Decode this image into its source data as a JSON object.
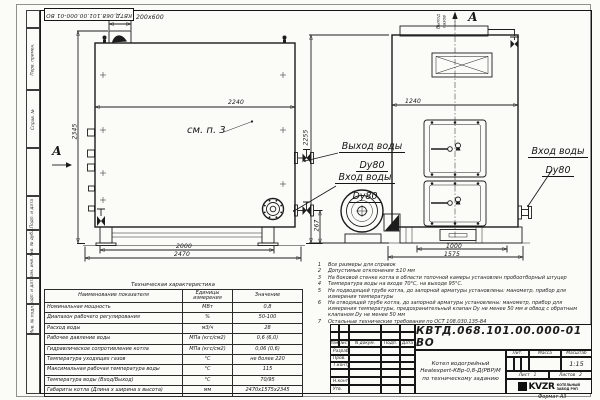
{
  "drawing": {
    "doc_number": "КВТД.068.101.00.000-01 ВО",
    "format_label": "Формат А3"
  },
  "frame": {
    "left_labels": [
      "Перв. примен.",
      "Справ. №",
      "Подп. и дата",
      "Инв. № дубл.",
      "Взам. инв. №",
      "Подп. и дата",
      "Инв. № подл."
    ]
  },
  "side_view": {
    "dim_chimney": "200х600",
    "dim_width": "2240",
    "dim_height": "2345",
    "dim_supports": "2000",
    "dim_length": "2470",
    "dim_conn_height": "267",
    "dim_front_height": "2255",
    "view_arrow_label": "А",
    "callout": "см. п. 3",
    "label_water_out": "Выход воды",
    "label_water_out_dn": "Dy80",
    "label_water_in": "Вход воды",
    "label_water_in_dn": "Dy80"
  },
  "front_view": {
    "section_label": "А",
    "gas_out_line1": "Выход",
    "gas_out_line2": "газов",
    "dim_width": "1240",
    "dim_base": "1000",
    "dim_base_overall": "1575",
    "label_water_in": "Вход воды",
    "label_water_in_dn": "Dy80"
  },
  "spec_table": {
    "title": "Техническая характеристика",
    "col_name": "Наименование показателя",
    "col_units": "Единицы измерения",
    "col_value": "Значение",
    "rows": [
      {
        "name": "Номинальная мощность",
        "units": "МВт",
        "value": "0,8"
      },
      {
        "name": "Диапазон рабочего регулирования",
        "units": "%",
        "value": "50-100"
      },
      {
        "name": "Расход воды",
        "units": "м3/ч",
        "value": "28"
      },
      {
        "name": "Рабочее давление воды",
        "units": "МПа (кгс/см2)",
        "value": "0,6 (6,0)"
      },
      {
        "name": "Гидравлическое сопротивление котла",
        "units": "МПа (кгс/см2)",
        "value": "0,06 (0,6)"
      },
      {
        "name": "Температура уходящих газов",
        "units": "°С",
        "value": "не более 220"
      },
      {
        "name": "Максимальная рабочая температура воды",
        "units": "°С",
        "value": "115"
      },
      {
        "name": "Температура воды (Вход/Выход)",
        "units": "°С",
        "value": "70/95"
      },
      {
        "name": "Габариты котла (Длина х ширина х высота)",
        "units": "мм",
        "value": "2470х1575х2345"
      }
    ]
  },
  "notes": {
    "items": [
      {
        "n": "1",
        "t": "Все размеры для справок"
      },
      {
        "n": "2",
        "t": "Допустимые отклонения ±10 мм"
      },
      {
        "n": "3",
        "t": "На боковой стенке котла в области топочной камеры установлен пробоотборный штуцер"
      },
      {
        "n": "4",
        "t": "Температура воды на входе 70°С, на выходе 95°С."
      },
      {
        "n": "5",
        "t": "На подводящей трубе котла, до запорной арматуры установлены: манометр, прибор для измерения температуры"
      },
      {
        "n": "6",
        "t": "На отводящей трубе котла, до запорной арматуры установлены: манометр, прибор для измерения температуры, предохранительный клапан Dy не менее 50 мм и обвод с обратным клапаном Dy не менее 50 мм"
      },
      {
        "n": "7",
        "t": "Остальные технические требования по ОСТ 108.030.135-84"
      }
    ]
  },
  "title_block": {
    "doc_number": "КВТД.068.101.00.000-01 ВО",
    "name_line1": "Котел водогрейный",
    "name_line2": "Heatexpert-КВр-0,8-Д(РВР)М",
    "name_line3": "по техническому заданию",
    "col_izm": "Изм.",
    "col_list": "Лист",
    "col_doc": "N докум.",
    "col_podp": "Подп.",
    "col_data": "Дата",
    "row_razrab": "Разраб.",
    "row_prov": "Пров.",
    "row_tkontr": "Т.контр.",
    "row_nkontr": "Н.контр.",
    "row_utv": "Утв.",
    "lit_label": "Лит.",
    "mass_label": "Масса",
    "scale_label": "Масштаб",
    "scale_value": "1:15",
    "sheet_label": "Лист",
    "sheet_value": "1",
    "sheets_label": "Листов",
    "sheets_value": "2",
    "logo_text": "KVZR",
    "company_line1": "КОТЕЛЬНЫЙ",
    "company_line2": "ЗАВОД РЭП"
  }
}
